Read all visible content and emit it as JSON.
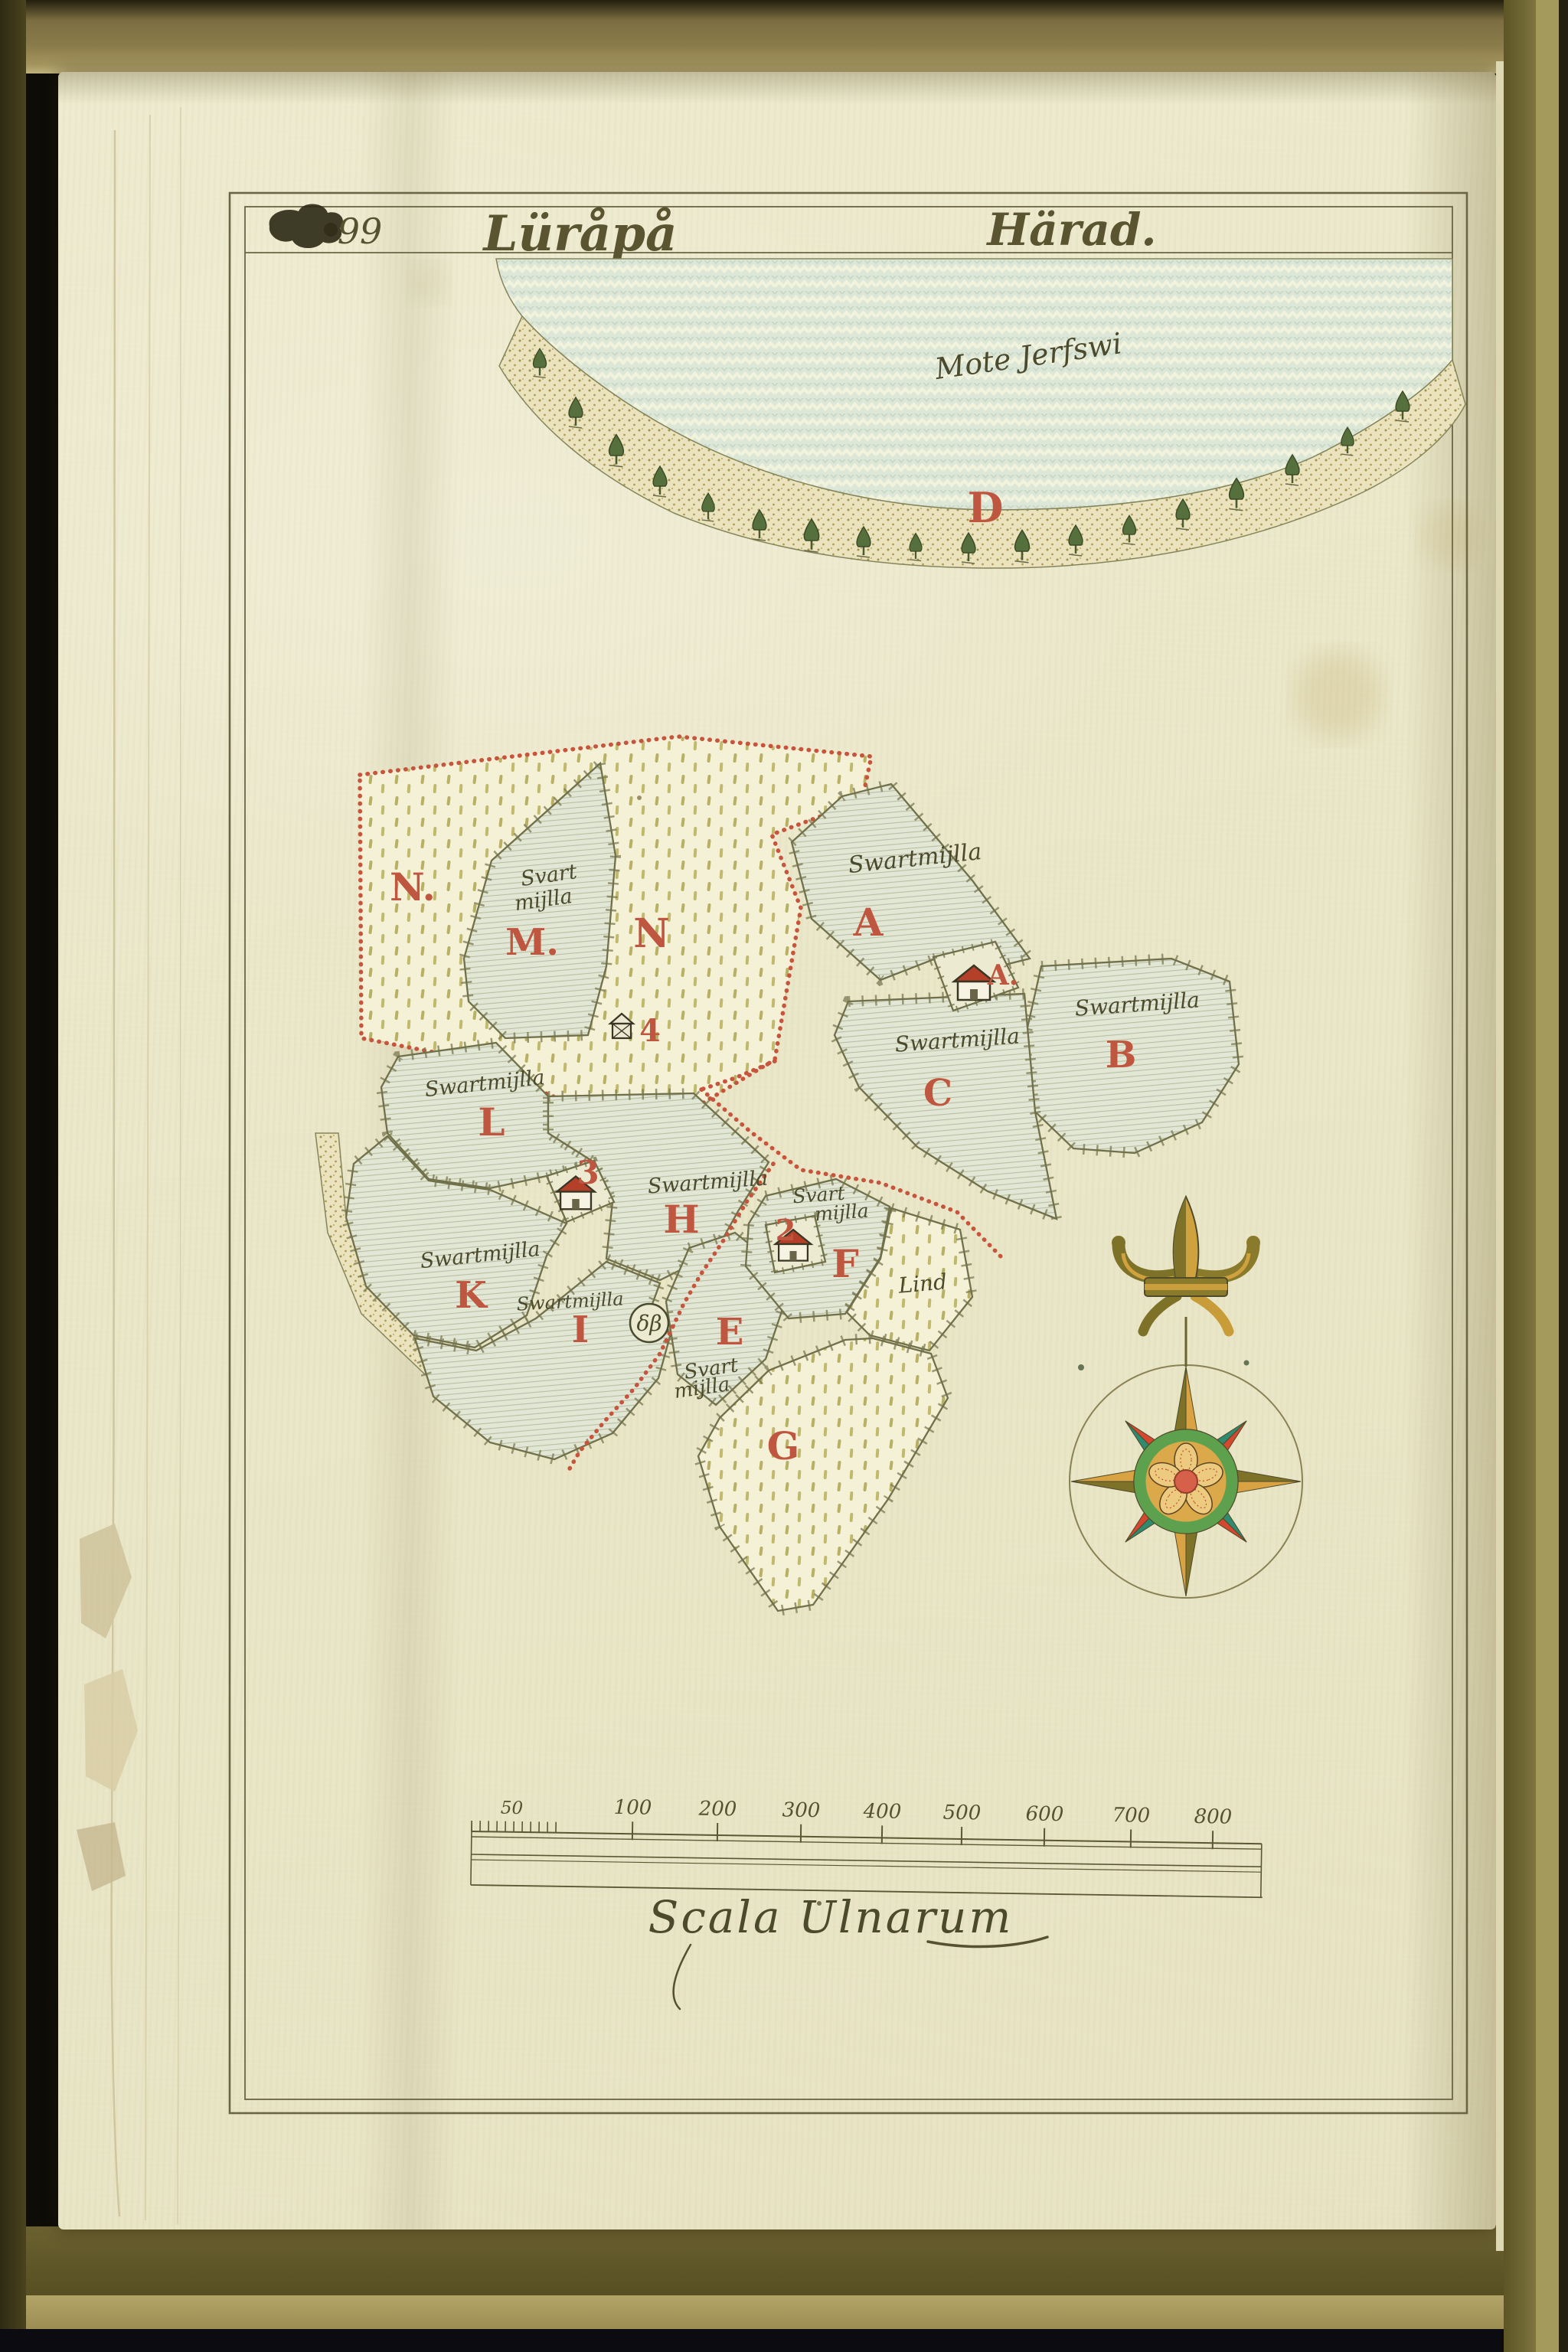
{
  "page": {
    "folio": "99",
    "title": "Lüråpå",
    "district": "Härad.",
    "scale_caption": "Scala Ulnarum",
    "scale_first_label": "50",
    "scale_labels": [
      "100",
      "200",
      "300",
      "400",
      "500",
      "600",
      "700",
      "800"
    ]
  },
  "lake": {
    "name": "Mote Jerfswi",
    "shore_letter": "D"
  },
  "parcels": {
    "letters": {
      "n_left": "N.",
      "m": "M.",
      "n_right": "N",
      "hut": "4",
      "a": "A",
      "a_house": "A.",
      "b": "B",
      "c": "C",
      "l": "L",
      "house3": "3",
      "h": "H",
      "k": "K",
      "house2": "2",
      "f": "F",
      "e": "E",
      "i": "I",
      "g": "G"
    },
    "soil": {
      "a": "Swartmijlla",
      "b": "Swartmijlla",
      "c": "Swartmijlla",
      "h": "Swartmijlla",
      "l": "Swartmijlla",
      "k": "Swartmijlla",
      "i": "Swartmijlla",
      "m1": "Svart",
      "m2": "mijlla",
      "f1": "Svart",
      "f2": "mijlla",
      "e1": "Svart",
      "e2": "mijlla",
      "lind": "Lind",
      "monogram": "δβ"
    }
  },
  "colors": {
    "red_letter": "#bf5740",
    "red_dotted": "#c7543c",
    "roof": "#b5402a",
    "ink": "#4c4a2c",
    "water": "#dde7d8",
    "paper": "#ebe8cd",
    "compass_gold": "#d9a344",
    "compass_olive": "#7d7227",
    "compass_teal": "#2f8a70",
    "compass_red": "#d6472f"
  }
}
